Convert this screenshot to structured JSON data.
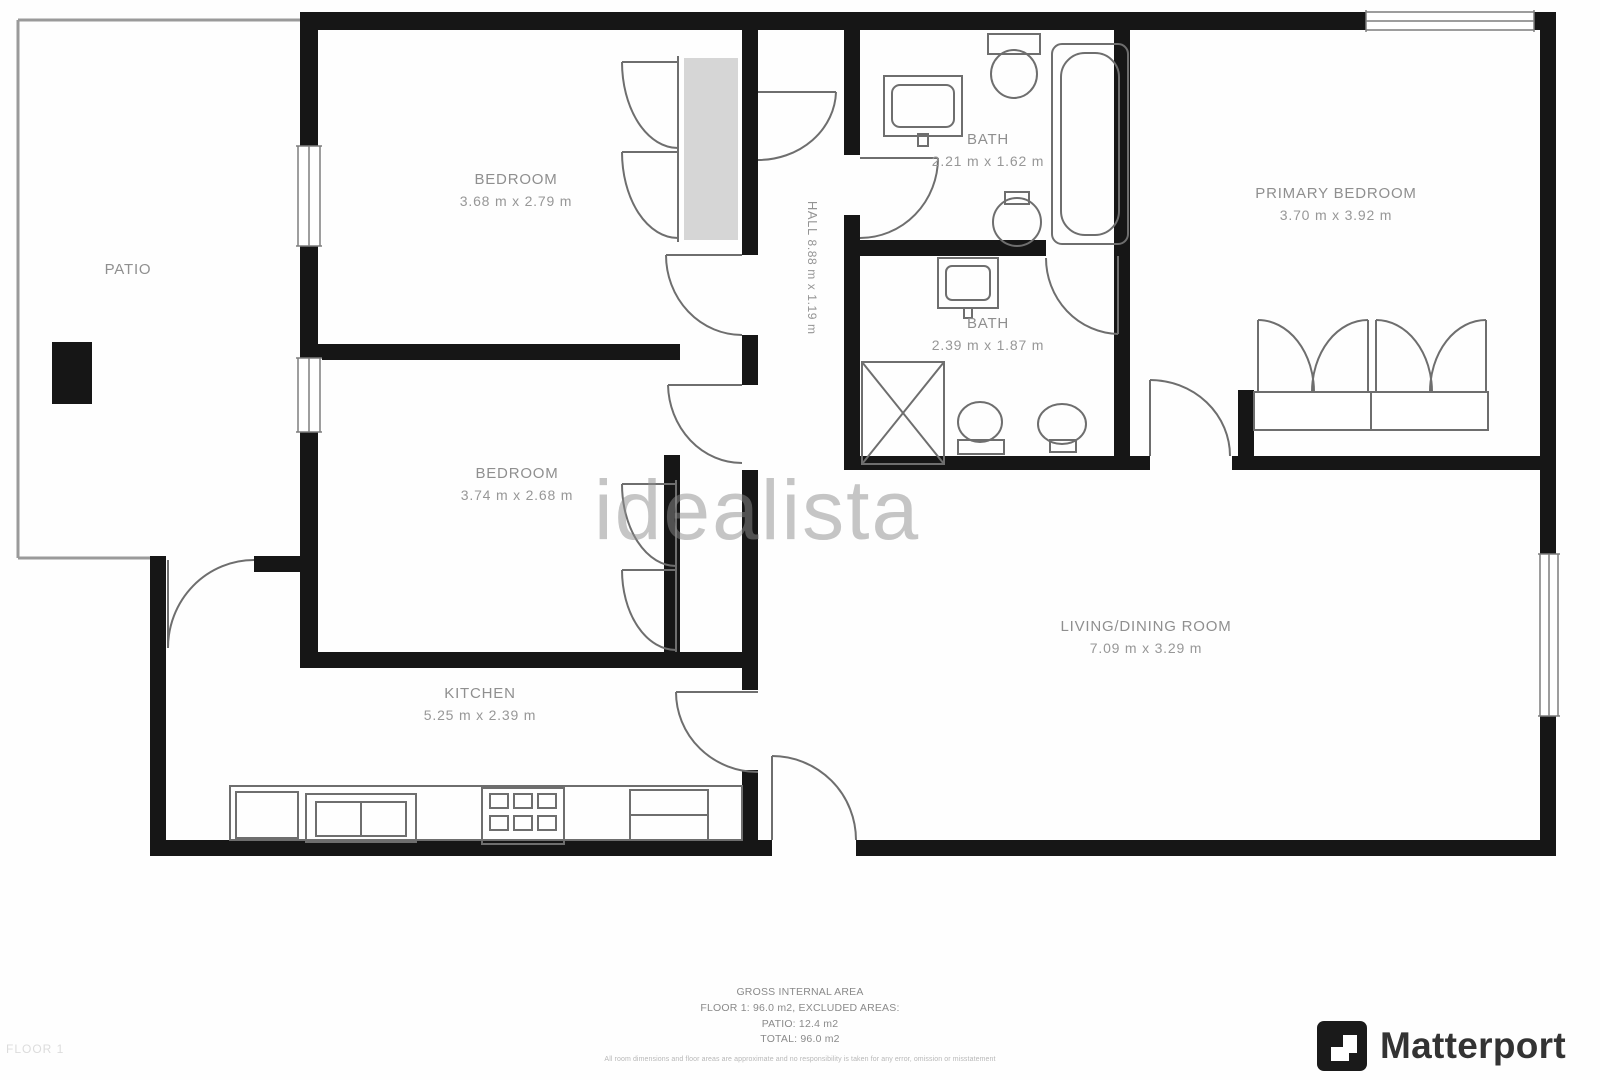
{
  "rooms": {
    "patio": {
      "name": "PATIO",
      "dims": ""
    },
    "bedroom1": {
      "name": "BEDROOM",
      "dims": "3.68 m x 2.79 m"
    },
    "bath1": {
      "name": "BATH",
      "dims": "2.21 m x 1.62 m"
    },
    "primary_bedroom": {
      "name": "PRIMARY BEDROOM",
      "dims": "3.70 m x 3.92 m"
    },
    "bath2": {
      "name": "BATH",
      "dims": "2.39 m x 1.87 m"
    },
    "bedroom2": {
      "name": "BEDROOM",
      "dims": "3.74 m x 2.68 m"
    },
    "kitchen": {
      "name": "KITCHEN",
      "dims": "5.25 m x 2.39 m"
    },
    "living_dining": {
      "name": "LIVING/DINING ROOM",
      "dims": "7.09 m x 3.29 m"
    },
    "hall": {
      "name": "HALL",
      "dims": "8.88 m x 1.19 m"
    }
  },
  "watermark": "idealista",
  "area_summary": {
    "line1": "GROSS INTERNAL AREA",
    "line2": "FLOOR 1: 96.0 m2, EXCLUDED AREAS:",
    "line3": "PATIO: 12.4 m2",
    "line4": "TOTAL: 96.0 m2",
    "disclaimer": "All room dimensions and floor areas are approximate and no responsibility is taken for any error, omission or misstatement"
  },
  "floor_tag": "FLOOR 1",
  "branding": {
    "name": "Matterport"
  },
  "colors": {
    "wall": "#161616",
    "fixture": "#6e6e6e",
    "label": "#8f8f8f"
  }
}
